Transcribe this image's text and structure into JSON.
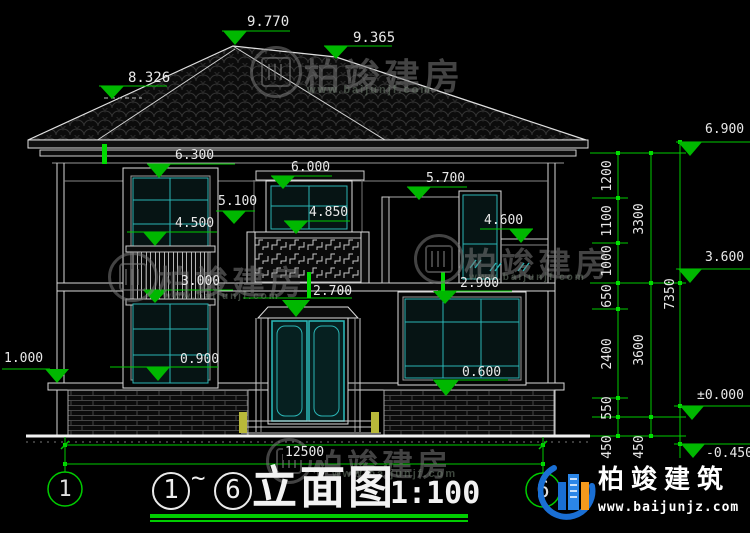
{
  "watermark": {
    "brand": "柏竣建房",
    "site": "www.baijunjf.com"
  },
  "publisher": {
    "brand": "柏竣建筑",
    "site": "www.baijunjz.com"
  },
  "axis": {
    "left": "1",
    "right": "6"
  },
  "title_block": {
    "from": "1",
    "tilde": "~",
    "to": "6",
    "title": "立面图",
    "scale": "1:100"
  },
  "levels": {
    "p9770": "9.770",
    "p9365": "9.365",
    "p8326": "8.326",
    "p6900": "6.900",
    "p6300": "6.300",
    "p6000": "6.000",
    "p5700": "5.700",
    "p5100": "5.100",
    "p4850": "4.850",
    "p4600": "4.600",
    "p4500": "4.500",
    "p3600": "3.600",
    "p3000": "3.000",
    "p2900": "2.900",
    "p2700": "2.700",
    "p1000": "1.000",
    "p0900": "0.900",
    "p0600": "0.600",
    "zero": "±0.000",
    "minus450": "-0.450"
  },
  "dims": {
    "v1200": "1200",
    "v1100": "1100",
    "v1000": "1000",
    "v650": "650",
    "v2400": "2400",
    "v550": "550",
    "v450_1": "450",
    "v3300": "3300",
    "v3600": "3600",
    "v450_2": "450",
    "v7350": "7350",
    "h12500": "12500"
  },
  "colors": {
    "annotation_green": "#00cc00",
    "window_cyan": "#2ab5b5",
    "line_white": "#e9e9e9",
    "logo_blue": "#1a6fd4",
    "logo_orange": "#f59a1d"
  }
}
